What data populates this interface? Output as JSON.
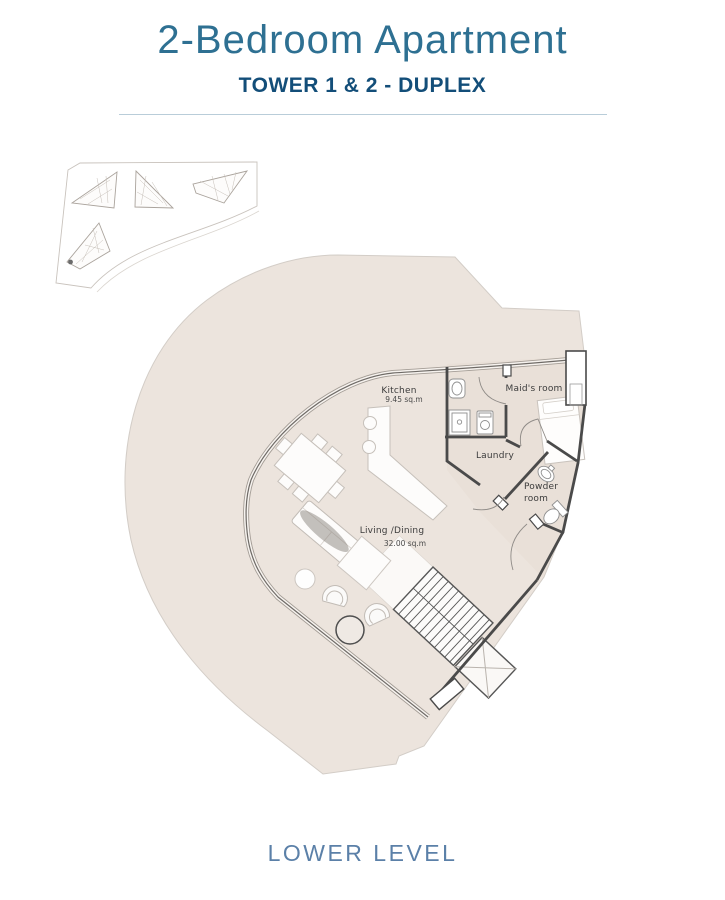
{
  "header": {
    "title": "2-Bedroom Apartment",
    "subtitle": "TOWER 1 & 2 - DUPLEX"
  },
  "key_map": {
    "description": "site key plan with four tower footprints",
    "towers": 4,
    "unit_marker": "lower-left tower tip"
  },
  "floor_plan": {
    "rooms": [
      {
        "name": "Kitchen",
        "area": "9.45 sq.m"
      },
      {
        "name": "Maid's room",
        "area": ""
      },
      {
        "name": "Laundry",
        "area": ""
      },
      {
        "name": "Powder room",
        "area": ""
      },
      {
        "name": "Living /Dining",
        "area": "32.00  sq.m"
      }
    ]
  },
  "footer": {
    "level_label": "LOWER LEVEL"
  },
  "colors": {
    "title": "#2e7092",
    "subtitle": "#134e79",
    "rule": "#b9cdd9",
    "level_label": "#5b80a8",
    "floor_fill": "#ece4dd",
    "room_tint": "#e8dcd4",
    "wall": "#4a4a4a",
    "furniture_stroke": "#c6c0ba"
  }
}
